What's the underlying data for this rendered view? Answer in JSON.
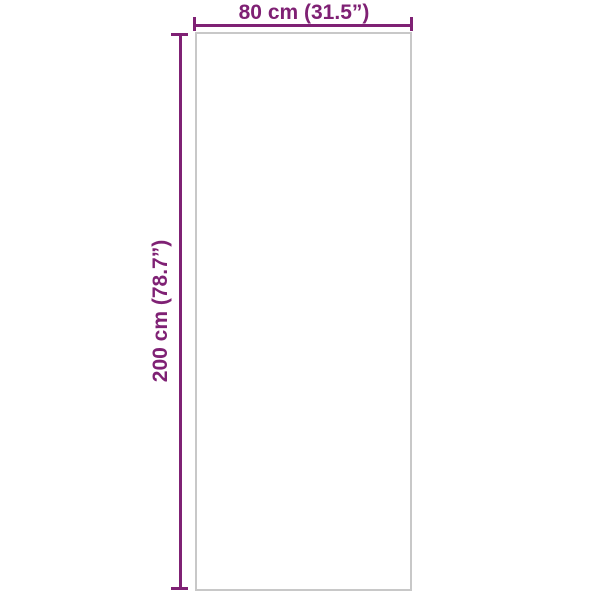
{
  "diagram": {
    "description": "product-dimension-diagram",
    "width_label": "80 cm (31.5”)",
    "height_label": "200 cm (78.7”)",
    "width_value_cm": 80,
    "width_value_inch": 31.5,
    "height_value_cm": 200,
    "height_value_inch": 78.7
  },
  "colors": {
    "accent": "#7f2174",
    "outline": "#c8c8c8",
    "background": "#ffffff"
  }
}
